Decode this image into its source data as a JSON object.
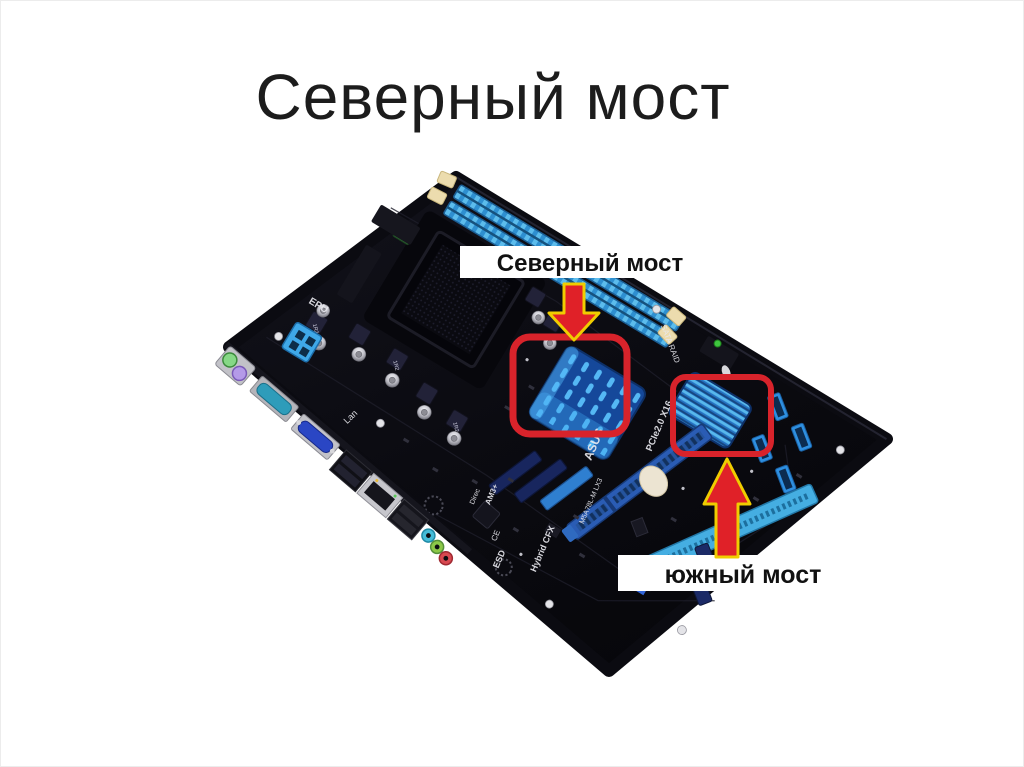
{
  "slide": {
    "title": "Северный мост",
    "background_color": "#ffffff"
  },
  "callouts": {
    "north_label": "Северный мост",
    "south_label": "южный мост",
    "box_color": "#d8232b",
    "arrow_fill_color": "#e02128",
    "arrow_outline_color": "#f0cd00",
    "label_band_color": "#ffffff",
    "label_text_color": "#111111"
  },
  "board": {
    "silkscreen": {
      "epu": "EPU",
      "lan": "Lan",
      "sata_raid": "SATA RAID",
      "pcie_slot": "PCIe2.0 X16",
      "asus_logo": "ASUS",
      "model": "M5A78L-M LX3",
      "hybrid_cfx": "Hybrid CFX",
      "am3": "AM3+",
      "direc": "Direc",
      "esd": "ESD",
      "ce_mark": "CE",
      "choke": "1R2"
    },
    "colors": {
      "pcb": "#0b0b11",
      "heatsink_blue": "#2e86e0",
      "ram_slot_blue": "#3f9fd8",
      "pcie_slot_blue": "#2a5cb4",
      "pci_slot_lightblue": "#45aee2"
    }
  }
}
